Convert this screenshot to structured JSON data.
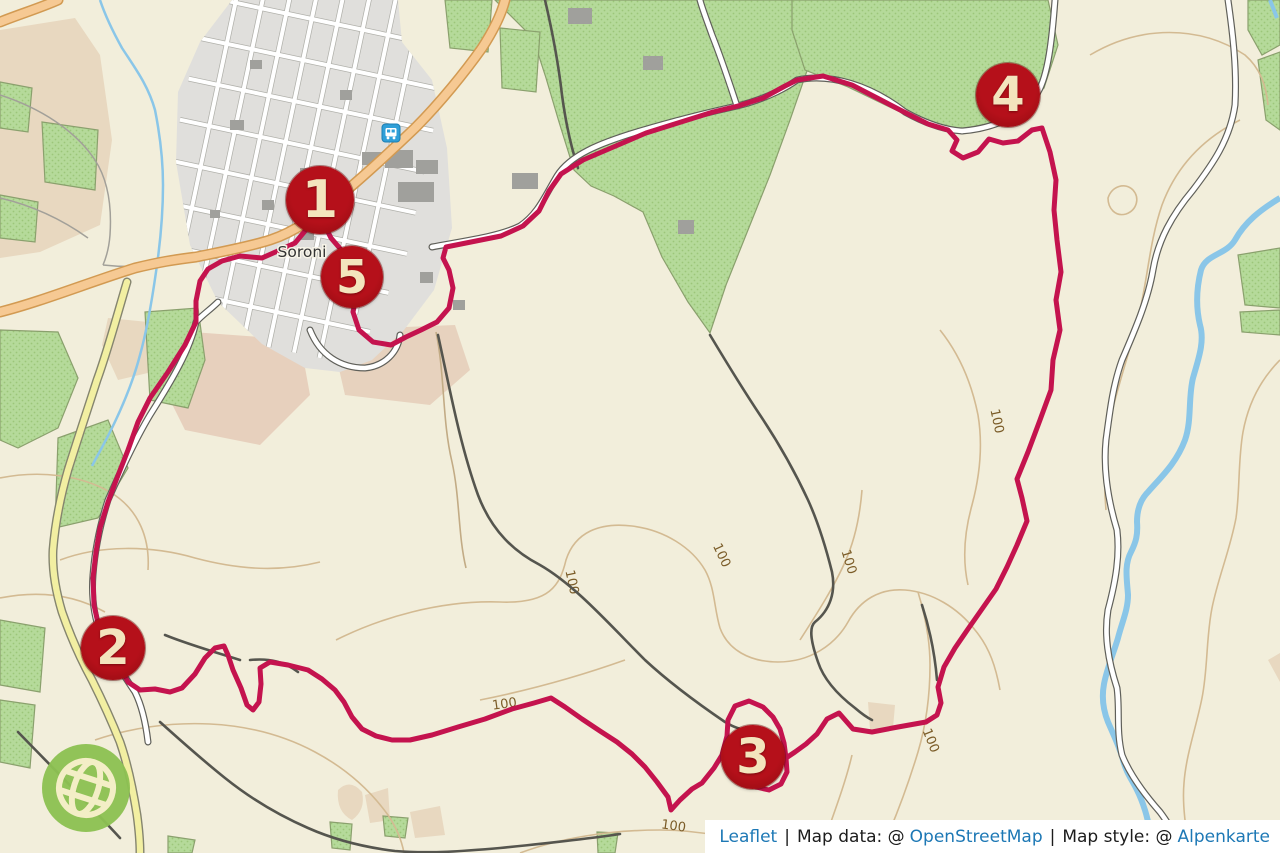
{
  "map": {
    "town_label": "Soroni",
    "contour_label": "100",
    "markers": [
      {
        "label": "1"
      },
      {
        "label": "2"
      },
      {
        "label": "3"
      },
      {
        "label": "4"
      },
      {
        "label": "5"
      }
    ]
  },
  "attribution": {
    "leaflet": "Leaflet",
    "separator": "|",
    "map_data_prefix": "Map data: @",
    "openstreetmap": "OpenStreetMap",
    "map_style_prefix": "Map style: @",
    "alpenkarte": "Alpenkarte"
  },
  "colors": {
    "route": "#c4134e",
    "marker": "#b5101a",
    "marker_text": "#f3e4bd",
    "link": "#1d78b5",
    "logo_green": "#8cc152",
    "water": "#8ac6e8",
    "forest": "#b5da9a",
    "contour": "#d3ba92",
    "road_orange": "#f6c993",
    "road_yellow": "#f2efa2",
    "background": "#f2eedb"
  }
}
